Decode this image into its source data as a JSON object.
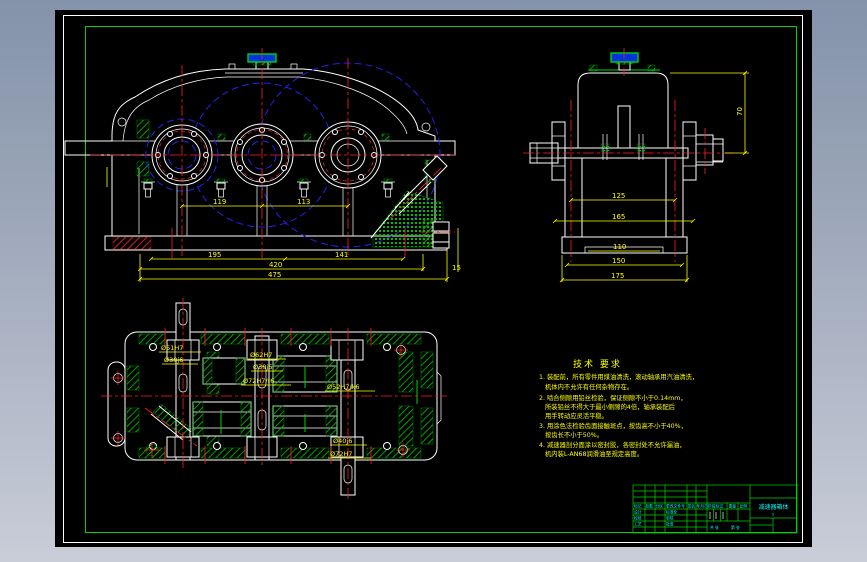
{
  "colors": {
    "background_top": "#8493aa",
    "background_bottom": "#c9cdd8",
    "canvas": "#000000",
    "outline": "#ffffff",
    "frame_green": "#00d400",
    "centerline_red": "#ff2020",
    "gear_circle_blue": "#2222ee",
    "dimension_yellow": "#ffff00",
    "titleblock_cyan": "#00ffff"
  },
  "scene": {
    "front_view": {
      "dim_center1": "119",
      "dim_center2": "113",
      "dim_base1": "195",
      "dim_base2": "141",
      "dim_total1": "420",
      "dim_total2": "475",
      "dim_plug": "15"
    },
    "side_view": {
      "dim_height": "70",
      "dim_w1": "125",
      "dim_w2": "165",
      "dim_w3": "110",
      "dim_w4": "150",
      "dim_w5": "175"
    },
    "top_view": {
      "bore1_line1": "Ø51H7",
      "bore1_line2": "Ø30j6",
      "bore2_line1": "Ø62H7",
      "bore2_line2": "Ø30j6",
      "bore3": "Ø72H7/r6",
      "bore4": "Ø52H7/k6",
      "bore5_line1": "Ø40j6",
      "bore5_line2": "Ø72H7"
    },
    "tech_notes": {
      "title": "技术 要求",
      "lines": [
        "1. 装配前，所有零件用煤油清洗，滚动轴承用汽油清洗，",
        "机体内不允许有任何杂物存在。",
        "2. 啮合侧隙用铅丝检验，保证侧隙不小于0.14mm，",
        "所装铅丝不得大于最小侧隙的4倍，轴承装配后",
        "用手转动应灵活平稳。",
        "3. 用涂色法检验齿面接触斑点，按齿高不小于40%，",
        "按齿长不小于50%。",
        "4. 减速器剖分面涂以密封胶，各密封处不允许漏油，",
        "机内装L-AN68润滑油至规定高度。"
      ]
    },
    "title_block": {
      "rev_header": [
        "标记",
        "处数",
        "分区",
        "更改文件号",
        "签名",
        "年月日"
      ],
      "roles_left": [
        "设计",
        "校核",
        "工艺"
      ],
      "roles_right": [
        "标准化",
        "审核",
        "批准"
      ],
      "stage_label": "阶段标记",
      "weight_label": "重量",
      "scale_label": "比例",
      "sheet_total": "共 张",
      "sheet_no": "第 张",
      "name": "减速器箱体",
      "code": "2"
    }
  }
}
